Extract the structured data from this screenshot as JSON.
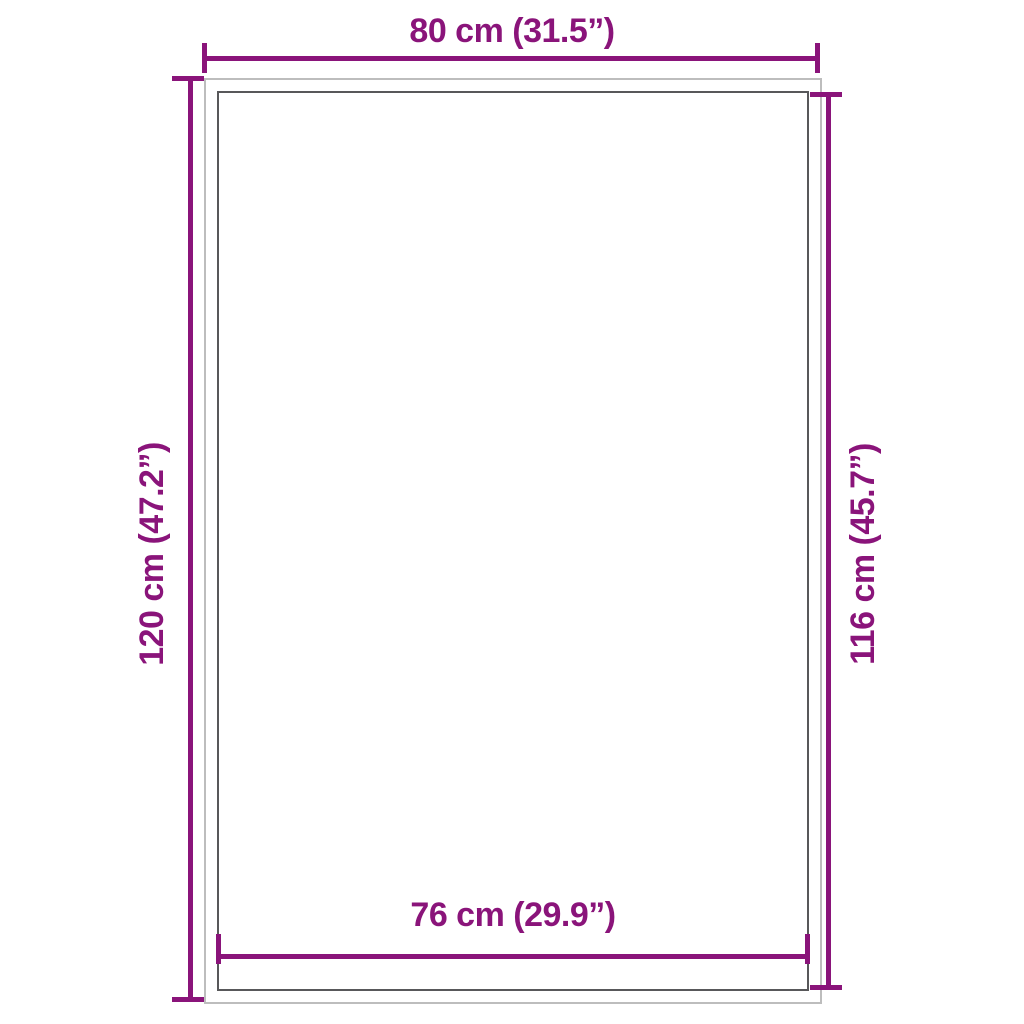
{
  "diagram": {
    "type": "product-dimension-diagram",
    "background": "#ffffff",
    "colors": {
      "dimension": "#8a147a",
      "outer_rect": "#bdbdbd",
      "inner_rect": "#58585a"
    },
    "dimensions": {
      "top": {
        "label": "80 cm (31.5”)",
        "value_cm": 80,
        "value_in": 31.5,
        "measures": "outer width"
      },
      "left": {
        "label": "120 cm (47.2”)",
        "value_cm": 120,
        "value_in": 47.2,
        "measures": "outer height"
      },
      "right": {
        "label": "116 cm (45.7”)",
        "value_cm": 116,
        "value_in": 45.7,
        "measures": "inner height"
      },
      "bottom": {
        "label": "76 cm (29.9”)",
        "value_cm": 76,
        "value_in": 29.9,
        "measures": "inner width"
      }
    }
  }
}
